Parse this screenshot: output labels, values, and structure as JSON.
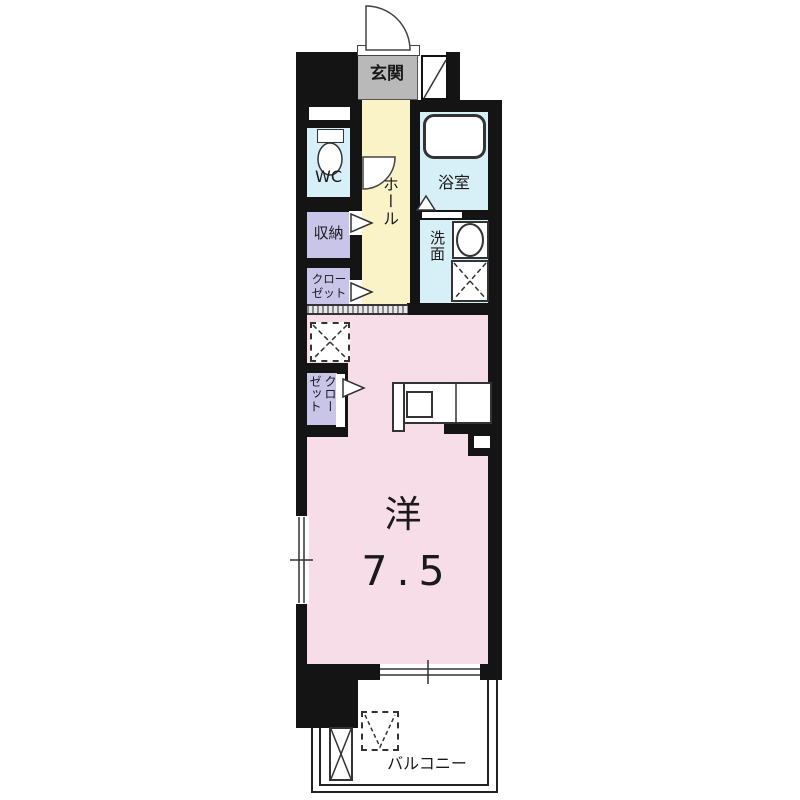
{
  "rooms": {
    "entrance": {
      "label": "玄関"
    },
    "toilet": {
      "label": "WC"
    },
    "hall": {
      "label": "ホール"
    },
    "bath": {
      "label": "浴室"
    },
    "washroom": {
      "label": "洗面"
    },
    "storage": {
      "label": "収納"
    },
    "closet_upper": {
      "label": "クローゼット"
    },
    "closet_lower": {
      "label": "クローゼット"
    },
    "living": {
      "label": "洋",
      "size": "7.5"
    },
    "balcony": {
      "label": "バルコニー"
    }
  },
  "colors": {
    "wall": "#141414",
    "genkan": "#b9b9b9",
    "hall": "#faf3c8",
    "wet": "#d7eff7",
    "storage": "#c8c5e9",
    "living": "#f7dde7"
  }
}
